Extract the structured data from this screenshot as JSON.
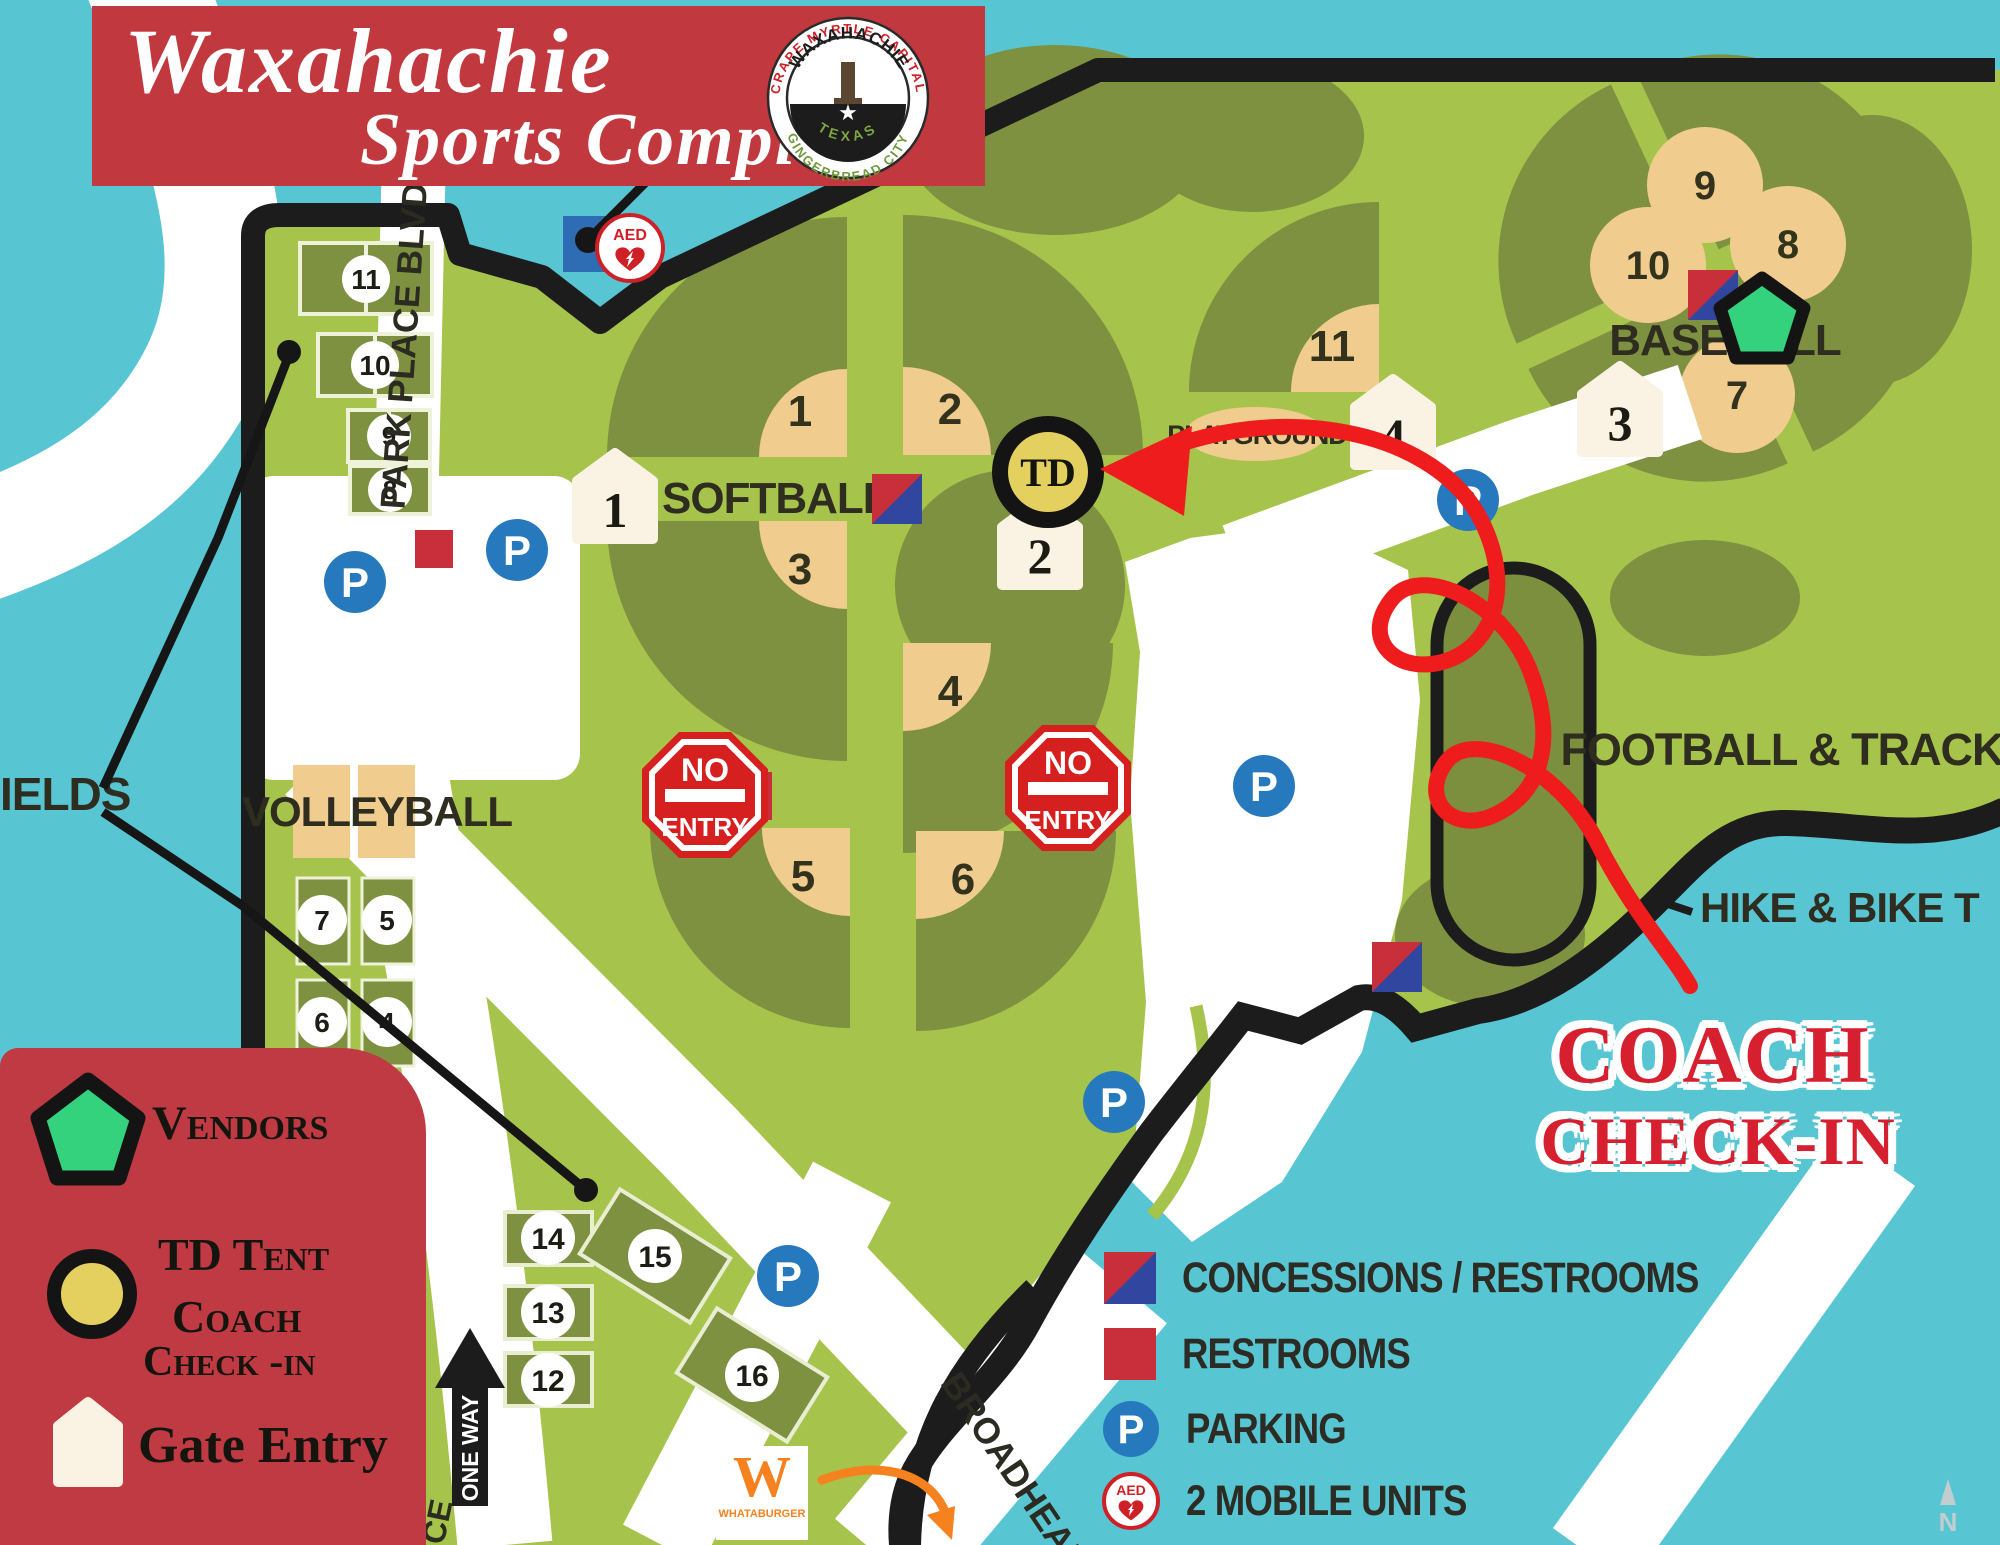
{
  "banner": {
    "line1": "Waxahachie",
    "line2": "Sports Complex"
  },
  "seal": {
    "arc_top": "CRAPE MYRTLE CAPITAL",
    "arc_bottom": "GINGERBREAD CITY",
    "city": "WAXAHACHIE",
    "state": "TEXAS",
    "star": "★"
  },
  "areas": {
    "softball": "SOFTBALL",
    "baseball": "BASEBALL",
    "volleyball": "VOLLEYBALL",
    "football_track": "FOOTBALL & TRACK",
    "hike_bike": "HIKE & BIKE T",
    "playground": "PLAYGROUND",
    "fields_partial": "IELDS"
  },
  "roads": {
    "park_place": "PARK PLACE BLVD E",
    "broadhead": "BROADHEAD",
    "one_way": "ONE WAY",
    "place_partial": "CE"
  },
  "markers": {
    "td": "TD",
    "p": "P",
    "no": "NO",
    "entry": "ENTRY",
    "aed": "AED"
  },
  "gate_numbers": {
    "g1": "1",
    "g2": "2",
    "g3": "3",
    "g4": "4"
  },
  "softball_fields": {
    "f1": "1",
    "f2": "2",
    "f3": "3",
    "f4": "4",
    "f5": "5",
    "f6": "6",
    "f11": "11"
  },
  "baseball_fields": {
    "f7": "7",
    "f8": "8",
    "f9": "9",
    "f10": "10"
  },
  "soccer_fields": {
    "f8": "8",
    "f9": "9",
    "f10": "10",
    "f11": "11",
    "f12": "12",
    "f13": "13",
    "f14": "14",
    "f15": "15",
    "f16": "16"
  },
  "volleyball_courts": {
    "c4": "4",
    "c5": "5",
    "c6": "6",
    "c7": "7"
  },
  "coach_checkin": {
    "line1": "COACH",
    "line2": "CHECK-IN"
  },
  "legend_left": {
    "vendors": "Vendors",
    "td_tent": "TD Tent",
    "coach": "Coach",
    "check_in": "Check -in",
    "gate_entry": "Gate Entry"
  },
  "legend_right": {
    "concessions": "CONCESSIONS / RESTROOMS",
    "restrooms": "RESTROOMS",
    "parking": "PARKING",
    "mobile_units": "2 MOBILE UNITS"
  },
  "brand": {
    "whataburger": "WHATABURGER",
    "w": "W"
  },
  "compass": {
    "n": "N"
  },
  "colors": {
    "water": "#58c5d3",
    "grass": "#a6c34b",
    "grass_dark": "#7d9140",
    "infield_tan": "#f0cd8e",
    "banner_red": "#c2383f",
    "sign_red": "#d6201f",
    "parking_blue": "#2779bd",
    "tent_yellow": "#e3d05e",
    "vendor_green": "#35d27e",
    "gate_cream": "#faf3e3",
    "ink": "#2e2d20"
  }
}
